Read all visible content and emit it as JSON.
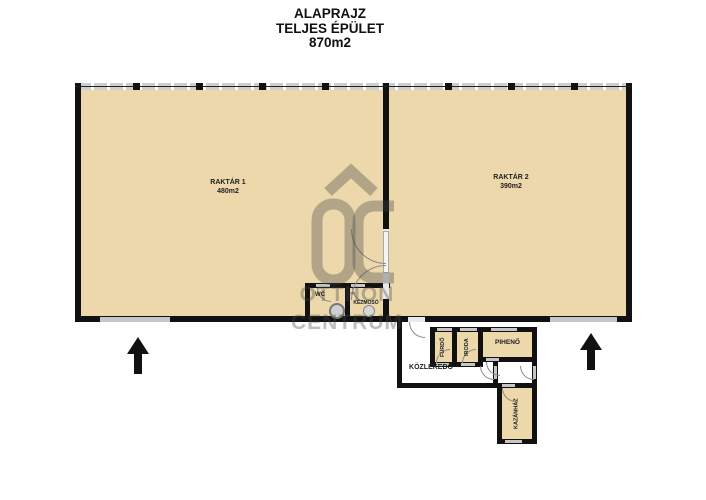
{
  "title": {
    "lines": [
      "ALAPRAJZ",
      "TELJES ÉPÜLET",
      "870m2"
    ]
  },
  "rooms": {
    "raktar1": {
      "name": "RAKTÁR 1",
      "area": "480m2"
    },
    "raktar2": {
      "name": "RAKTÁR 2",
      "area": "390m2"
    },
    "wc": {
      "name": "WC"
    },
    "kezmoso": {
      "name": "KÉZMOSÓ"
    },
    "furdo": {
      "name": "FÜRDŐ"
    },
    "iroda": {
      "name": "IRODA"
    },
    "piheno": {
      "name": "PIHENŐ"
    },
    "kozlekedo": {
      "name": "KÖZLEKEDŐ"
    },
    "kazanhaz": {
      "name": "KAZÁNHÁZ"
    }
  },
  "watermark": {
    "logo": "OC",
    "line1": "OTTHON",
    "line2": "CENTRUM"
  },
  "icons": {
    "entrance_arrows": "up-arrow-icon",
    "logo_roof": "roof-chevron-icon"
  },
  "colors": {
    "room_fill": "#ecd8ab",
    "wall": "#111111",
    "opening_gray": "#c6c6c6",
    "watermark": "rgba(70,70,70,0.35)"
  }
}
